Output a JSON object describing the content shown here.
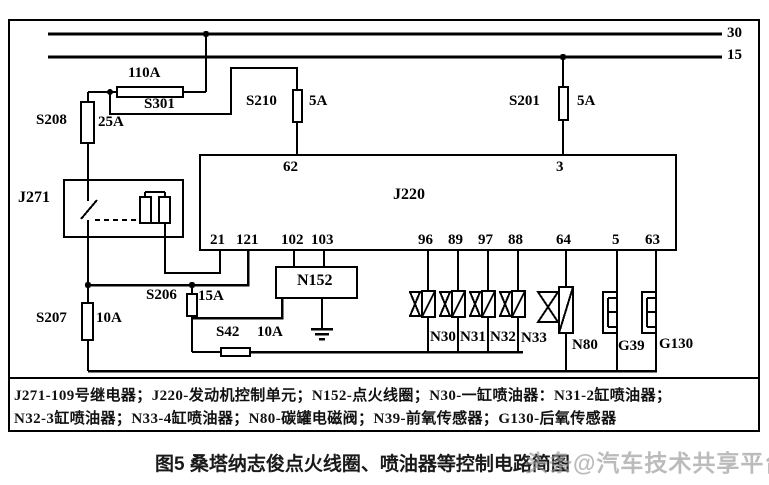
{
  "colors": {
    "line": "#000000",
    "text": "#111111",
    "watermark": "#969696",
    "background": "#ffffff"
  },
  "power": {
    "t30": "30",
    "t15": "15"
  },
  "fuses": {
    "s301": {
      "name": "S301",
      "rating": "110A"
    },
    "s208": {
      "name": "S208",
      "rating": "25A"
    },
    "s210": {
      "name": "S210",
      "rating": "5A"
    },
    "s201": {
      "name": "S201",
      "rating": "5A"
    },
    "s206": {
      "name": "S206",
      "rating": "15A"
    },
    "s207": {
      "name": "S207",
      "rating": "10A"
    },
    "s42": {
      "name": "S42",
      "rating": "10A"
    }
  },
  "relay": {
    "name": "J271"
  },
  "ecu": {
    "name": "J220",
    "pins_top": {
      "p62": "62",
      "p3": "3"
    },
    "pins_bottom": [
      "21",
      "121",
      "102",
      "103",
      "96",
      "89",
      "97",
      "88",
      "64",
      "5",
      "63"
    ]
  },
  "coil": {
    "name": "N152"
  },
  "loads": {
    "injectors": [
      "N30",
      "N31",
      "N32",
      "N33"
    ],
    "evap_valve": "N80",
    "o2_front": "G39",
    "o2_rear": "G130"
  },
  "legend": {
    "line1": "J271-109号继电器；J220-发动机控制单元；N152-点火线圈；N30-一缸喷油器：N31-2缸喷油器；",
    "line2": "N32-3缸喷油器；N33-4缸喷油器；N80-碳罐电磁阀；N39-前氧传感器；G130-后氧传感器"
  },
  "caption": "图5 桑塔纳志俊点火线圈、喷油器等控制电路简图",
  "watermark": "头条@汽车技术共享平台"
}
